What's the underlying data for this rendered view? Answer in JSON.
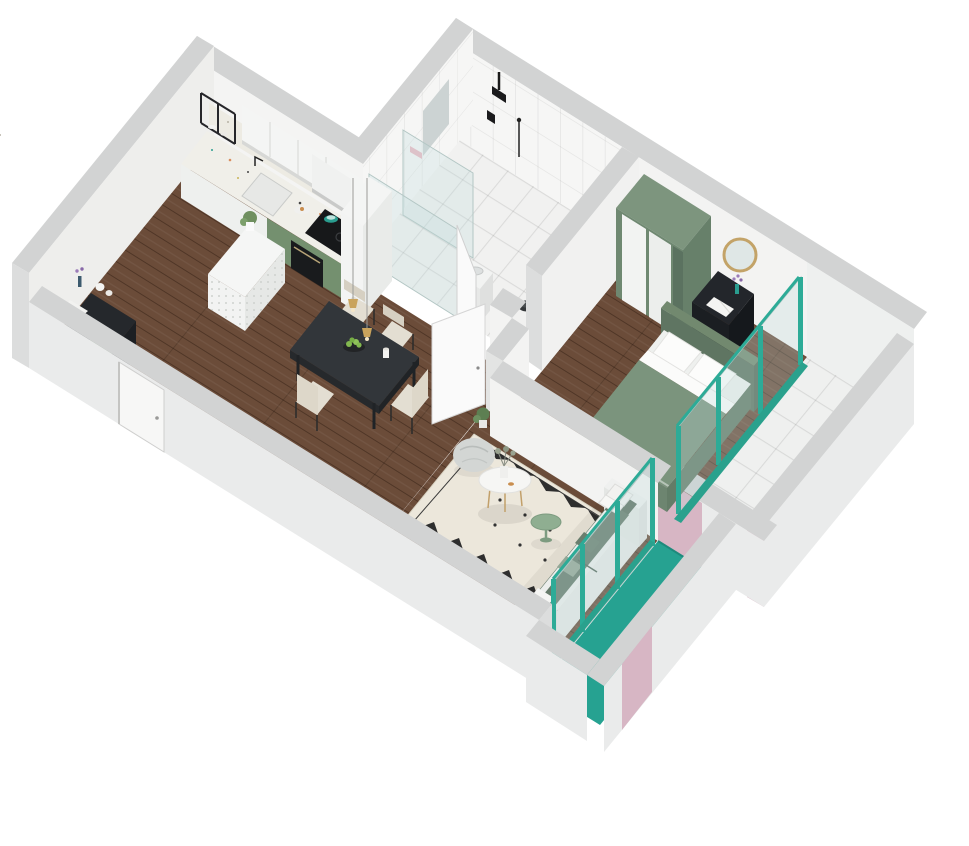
{
  "scene": {
    "type": "isometric-3d-floor-plan",
    "description": "Dollhouse cutaway render of a one-bedroom apartment on a white background",
    "rooms": [
      {
        "id": "bathroom",
        "contents": [
          "walk-in-shower",
          "glass-partition",
          "rain-shower-head",
          "toilet",
          "washbasin",
          "mirror-panel",
          "soap-shelf"
        ]
      },
      {
        "id": "bedroom",
        "contents": [
          "double-bed",
          "sliding-wardrobe",
          "vanity-desk",
          "round-mirror",
          "stool",
          "flower-vase"
        ]
      },
      {
        "id": "bedroom-balcony",
        "contents": [
          "tiled-floor",
          "teal-window-track"
        ]
      },
      {
        "id": "kitchen-dining",
        "contents": [
          "kitchen-counter",
          "upper-cabinets",
          "cooker-hood",
          "induction-hob",
          "oven",
          "sink",
          "wall-shelf",
          "perforated-island",
          "tall-cabinet",
          "dining-table",
          "dining-chairs",
          "pendant-lights",
          "fruit-bowl"
        ]
      },
      {
        "id": "entry",
        "contents": [
          "console-cabinet",
          "entry-door",
          "plates",
          "flower-vase"
        ]
      },
      {
        "id": "living-room",
        "contents": [
          "sofa",
          "patterned-rug",
          "coffee-table",
          "side-table",
          "bean-bag",
          "plant"
        ]
      },
      {
        "id": "living-balcony",
        "contents": [
          "teal-floor",
          "teal-window-frames"
        ]
      }
    ]
  },
  "palette": {
    "teal": "#26a291",
    "teal_frame": "#2dab97",
    "wood": "#6b4c39",
    "wall_top": "#d2d3d3",
    "wall_light": "#f3f3f2",
    "wall_outer": "#eaebeb",
    "tile": "#f1f1f0",
    "green_bed": "#7b947d",
    "green_bed_dark": "#5f7562",
    "green_sofa_seat": "#667b6b",
    "green_sofa_back": "#5d7162",
    "green_wardrobe": "#7d957e",
    "green_cabinet": "#74906f",
    "green_side_table": "#8fae91",
    "pink": "#d7b6c4",
    "rug": "#ece7db",
    "dark_furniture": "#23262b",
    "table_dark": "#32363a",
    "gold": "#c9a35c",
    "apple_green": "#82b84f"
  }
}
